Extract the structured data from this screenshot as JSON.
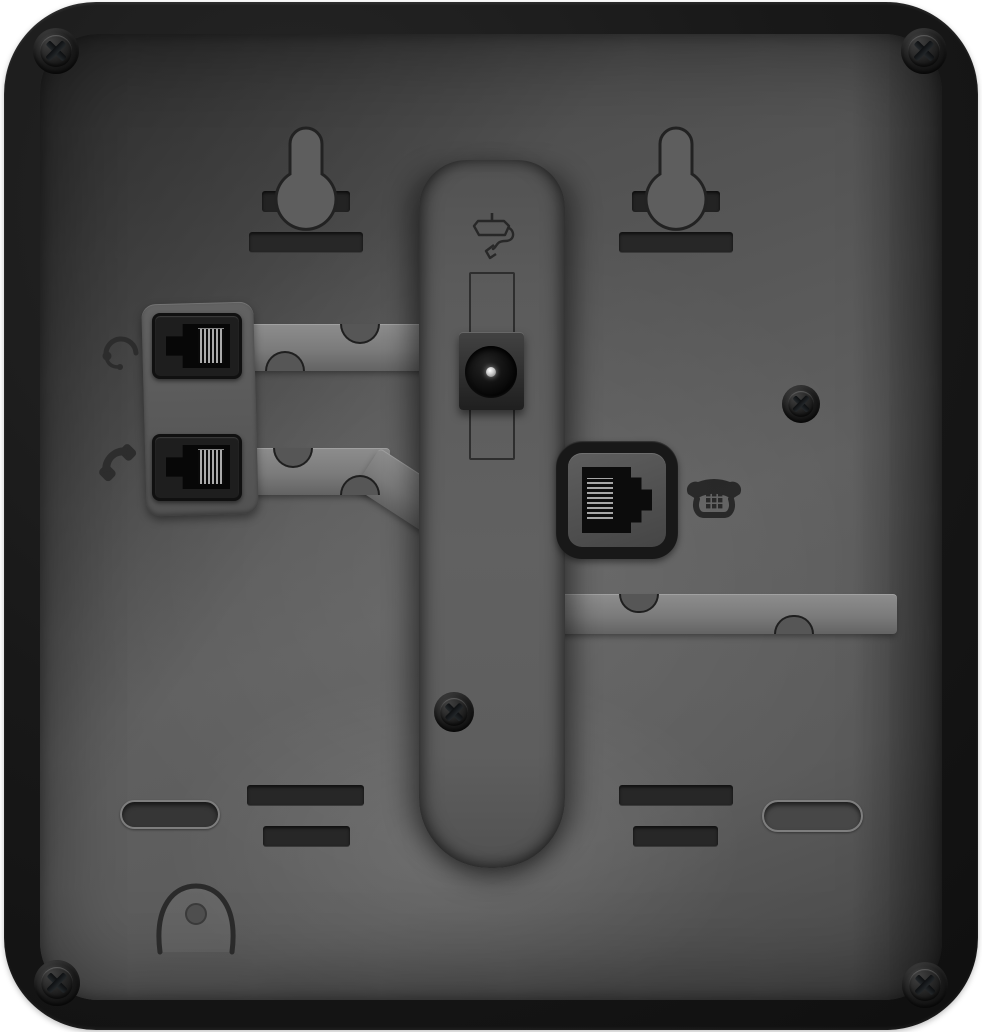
{
  "scene": {
    "description": "Rear panel of a black desk telephone",
    "page_background": "#ffffff"
  },
  "colors": {
    "body_shell": "#161616",
    "back_panel": "#5b5b5b",
    "engraved_slot": "#272727",
    "cable_channel": "#7f7f7f",
    "port_housing": "#1e1e1e",
    "socket_interior": "#070707",
    "pin_contacts": "#ababab",
    "dc_pin_highlight": "#ffffff",
    "screw_head": "#3b4046"
  },
  "components": {
    "headset_port": {
      "label": "Headset jack (RJ9)",
      "icon": "headset-icon"
    },
    "handset_port": {
      "label": "Handset jack (RJ9)",
      "icon": "handset-icon"
    },
    "power_jack": {
      "label": "DC power input jack",
      "icon": "power-adapter-icon"
    },
    "line_port": {
      "label": "Telephone line jack (RJ45)",
      "icon": "telephone-icon"
    },
    "wall_mount_left": {
      "label": "Wall-mount keyhole slot (left)"
    },
    "wall_mount_right": {
      "label": "Wall-mount keyhole slot (right)"
    },
    "stand_channel": {
      "label": "Stand mounting channel"
    },
    "cable_channel_upper_left": {
      "label": "Cable routing channel (headset)"
    },
    "cable_channel_lower_left": {
      "label": "Cable routing channel (handset)"
    },
    "cable_channel_right": {
      "label": "Cable routing channel (line cord)"
    },
    "corner_screws": {
      "label": "Corner screw",
      "count": 4
    },
    "stand_screw": {
      "label": "Stand channel screw"
    },
    "side_screw": {
      "label": "Panel screw"
    },
    "mount_slot": {
      "label": "Mounting slot",
      "count": 4
    },
    "foot_recess_left": {
      "label": "Foot recess (left)"
    },
    "foot_recess_right": {
      "label": "Foot recess (right)"
    },
    "hanger_hook": {
      "label": "Handset hanger hook recess"
    }
  }
}
